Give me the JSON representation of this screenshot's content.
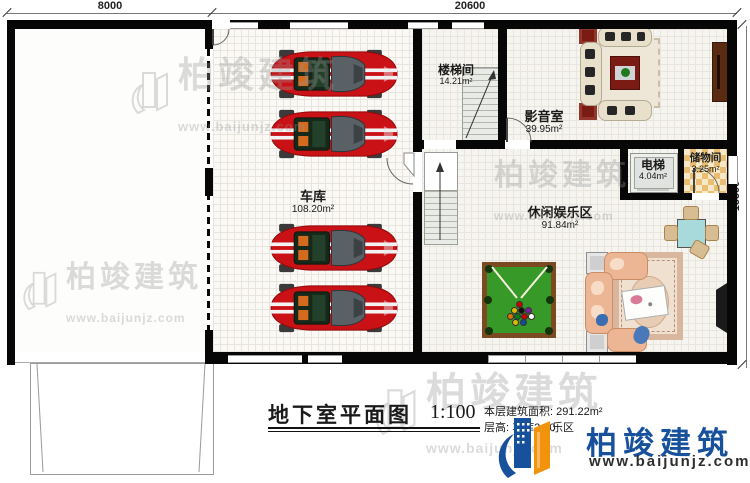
{
  "dimensions": {
    "top_left": "8000",
    "top_right": "20600",
    "right": "15500"
  },
  "rooms": {
    "garage": {
      "name": "车库",
      "area": "108.20m²"
    },
    "stairwell": {
      "name": "楼梯间",
      "area": "14.21m²"
    },
    "media": {
      "name": "影音室",
      "area": "39.95m²"
    },
    "elevator": {
      "name": "电梯",
      "area": "4.04m²"
    },
    "storage": {
      "name": "储物间",
      "area": "3.25m²"
    },
    "leisure": {
      "name": "休闲娱乐区",
      "area": "91.84m²"
    }
  },
  "title": {
    "text": "地下室平面图",
    "scale": "1:100"
  },
  "info": {
    "line1": "本层建筑面积: 291.22m²",
    "line2": "层高: 车库2.80",
    "line2_fragment": "乐区"
  },
  "logo": {
    "name": "柏竣建筑",
    "url": "www.baijunjz.com"
  },
  "watermark": {
    "name": "柏竣建筑",
    "url": "www.baijunjz.com"
  },
  "colors": {
    "wall": "#070707",
    "car-red": "#c91116",
    "pool-green": "#379a28",
    "pool-frame": "#7b4a21",
    "elevator-cab": "#e0e3df",
    "storage-check": "#e9bd72",
    "media-sofa": "#e9e0cc",
    "accent-red-table": "#7a1c14",
    "leisure-sofa": "#ecb694",
    "teal-table": "#a8dadc",
    "chair": "#d9bd92",
    "logo-blue": "#17519c",
    "logo-orange": "#f2930d"
  }
}
